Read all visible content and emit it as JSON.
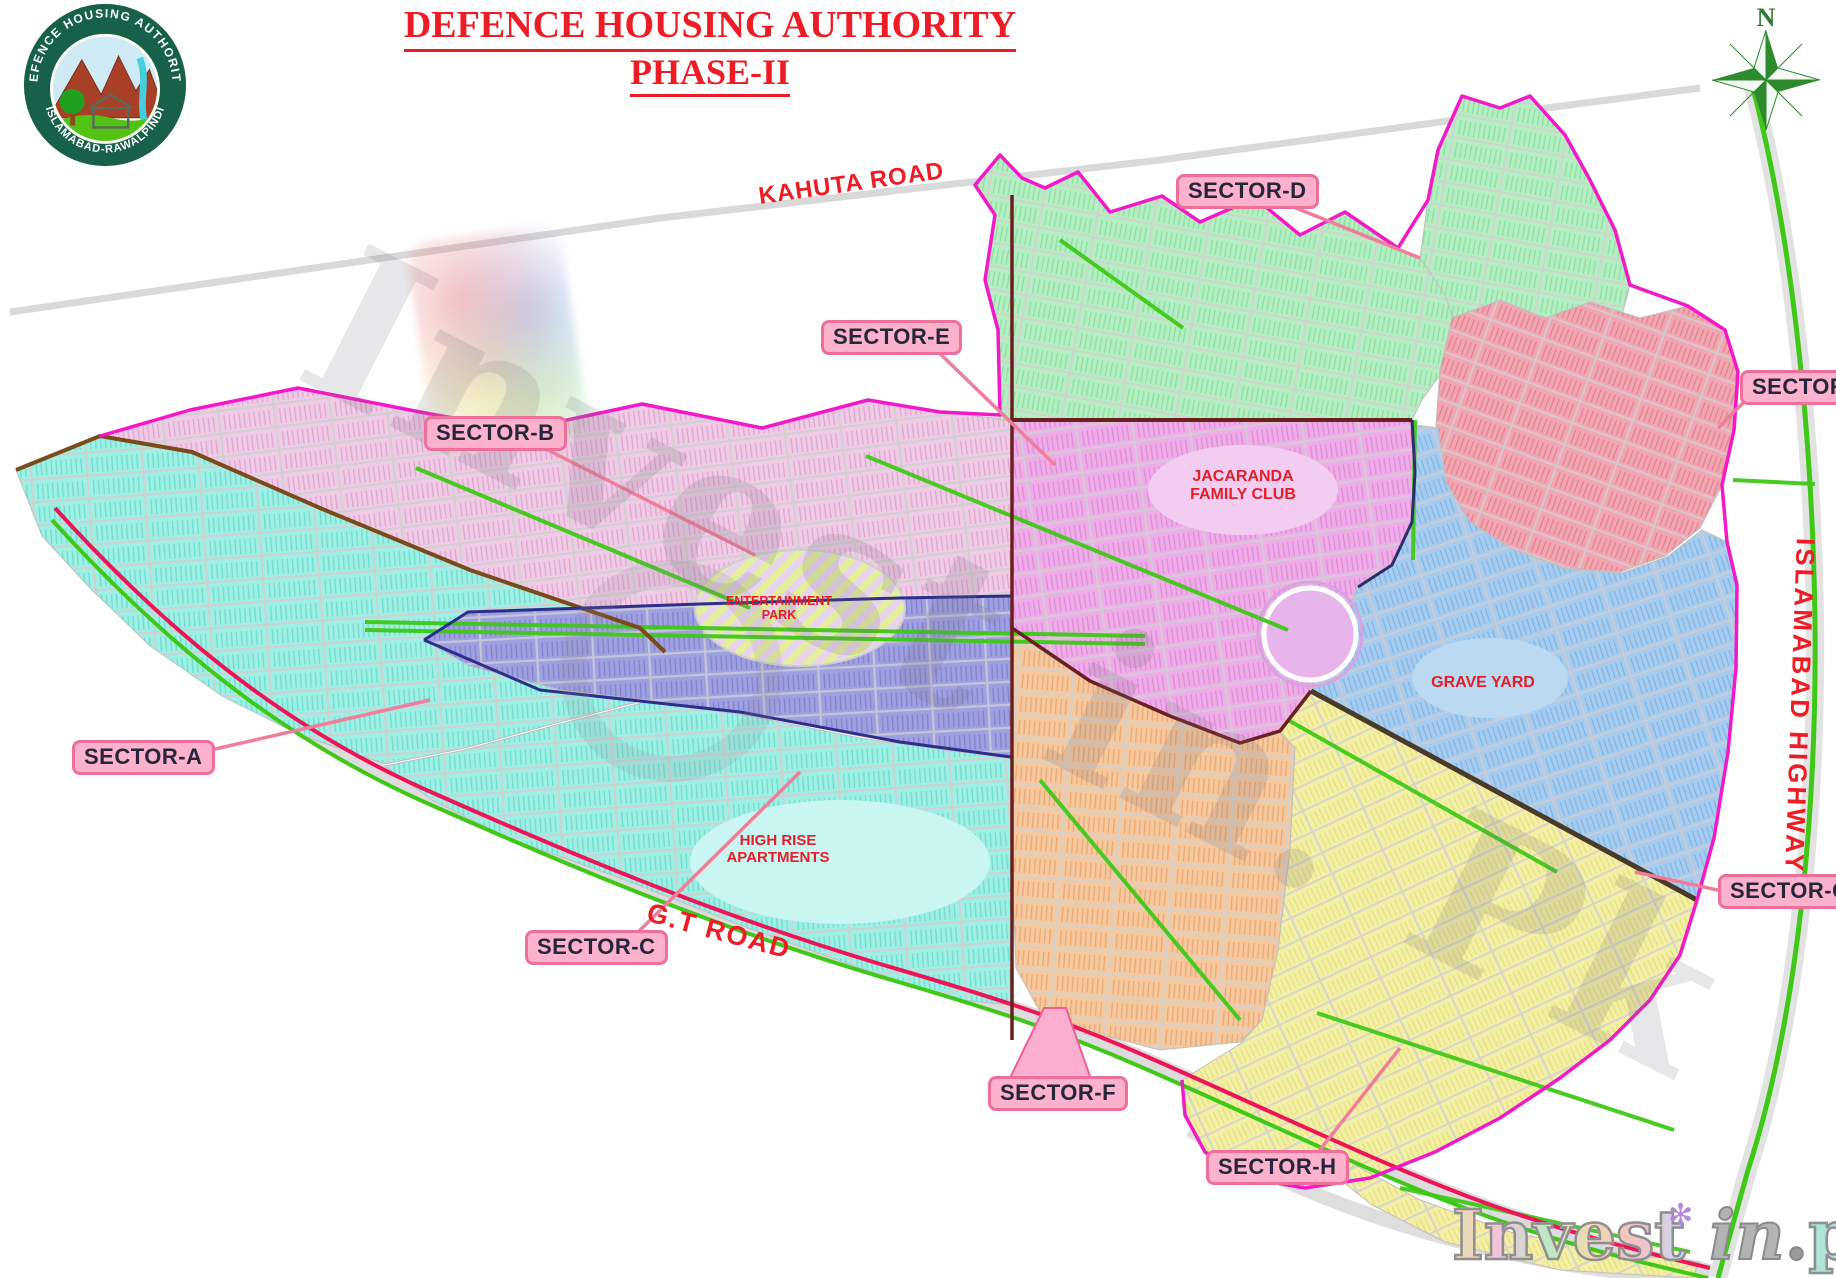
{
  "title": {
    "line1": "DEFENCE HOUSING AUTHORITY",
    "line2": "PHASE-II"
  },
  "logo": {
    "arc_top": "DEFENCE HOUSING AUTHORITY",
    "arc_bottom": "ISLAMABAD-RAWALPINDI"
  },
  "compass": {
    "north": "N"
  },
  "roads": {
    "kahuta": "KAHUTA ROAD",
    "gt": "G.T ROAD",
    "islamabad": "ISLAMABAD HIGHWAY"
  },
  "sectors": {
    "a": {
      "label": "SECTOR-A",
      "color": "#9ef0e4"
    },
    "b": {
      "label": "SECTOR-B",
      "color": "#f0cbe6"
    },
    "c": {
      "label": "SECTOR-C",
      "color": "#9fa0e0"
    },
    "d": {
      "label": "SECTOR-D",
      "color": "#b4efc2"
    },
    "e": {
      "label": "SECTOR-E",
      "color": "#eeade8"
    },
    "f": {
      "label": "SECTOR-F",
      "color": "#f6c89e"
    },
    "g": {
      "label": "SECTOR-G",
      "color": "#a6cdf0"
    },
    "h": {
      "label": "SECTOR-H",
      "color": "#f3f0a6"
    },
    "j": {
      "label": "SECTOR-J",
      "color": "#f1a6b2"
    }
  },
  "places": {
    "jacaranda_line1": "JACARANDA",
    "jacaranda_line2": "FAMILY CLUB",
    "grave_yard": "GRAVE YARD",
    "high_rise_line1": "HIGH RISE",
    "high_rise_line2": "APARTMENTS",
    "entertainment_line1": "ENTERTAINMENT",
    "entertainment_line2": "PARK"
  },
  "watermark": {
    "center": "Invest in. Pk",
    "brand_invest": "Invest",
    "brand_in": " in",
    "brand_dot": ".",
    "brand_pk": "pk"
  },
  "icons": {
    "flower": "✻"
  },
  "palette": {
    "label_bg": "#fcb1cd",
    "label_border": "#ee6f9c",
    "road_text_red": "#ee1c25",
    "gt_road_crimson": "#ed1558",
    "boundary_magenta": "#f318c8",
    "green_road": "#3fc818",
    "gray_road": "#d5d5d5"
  }
}
